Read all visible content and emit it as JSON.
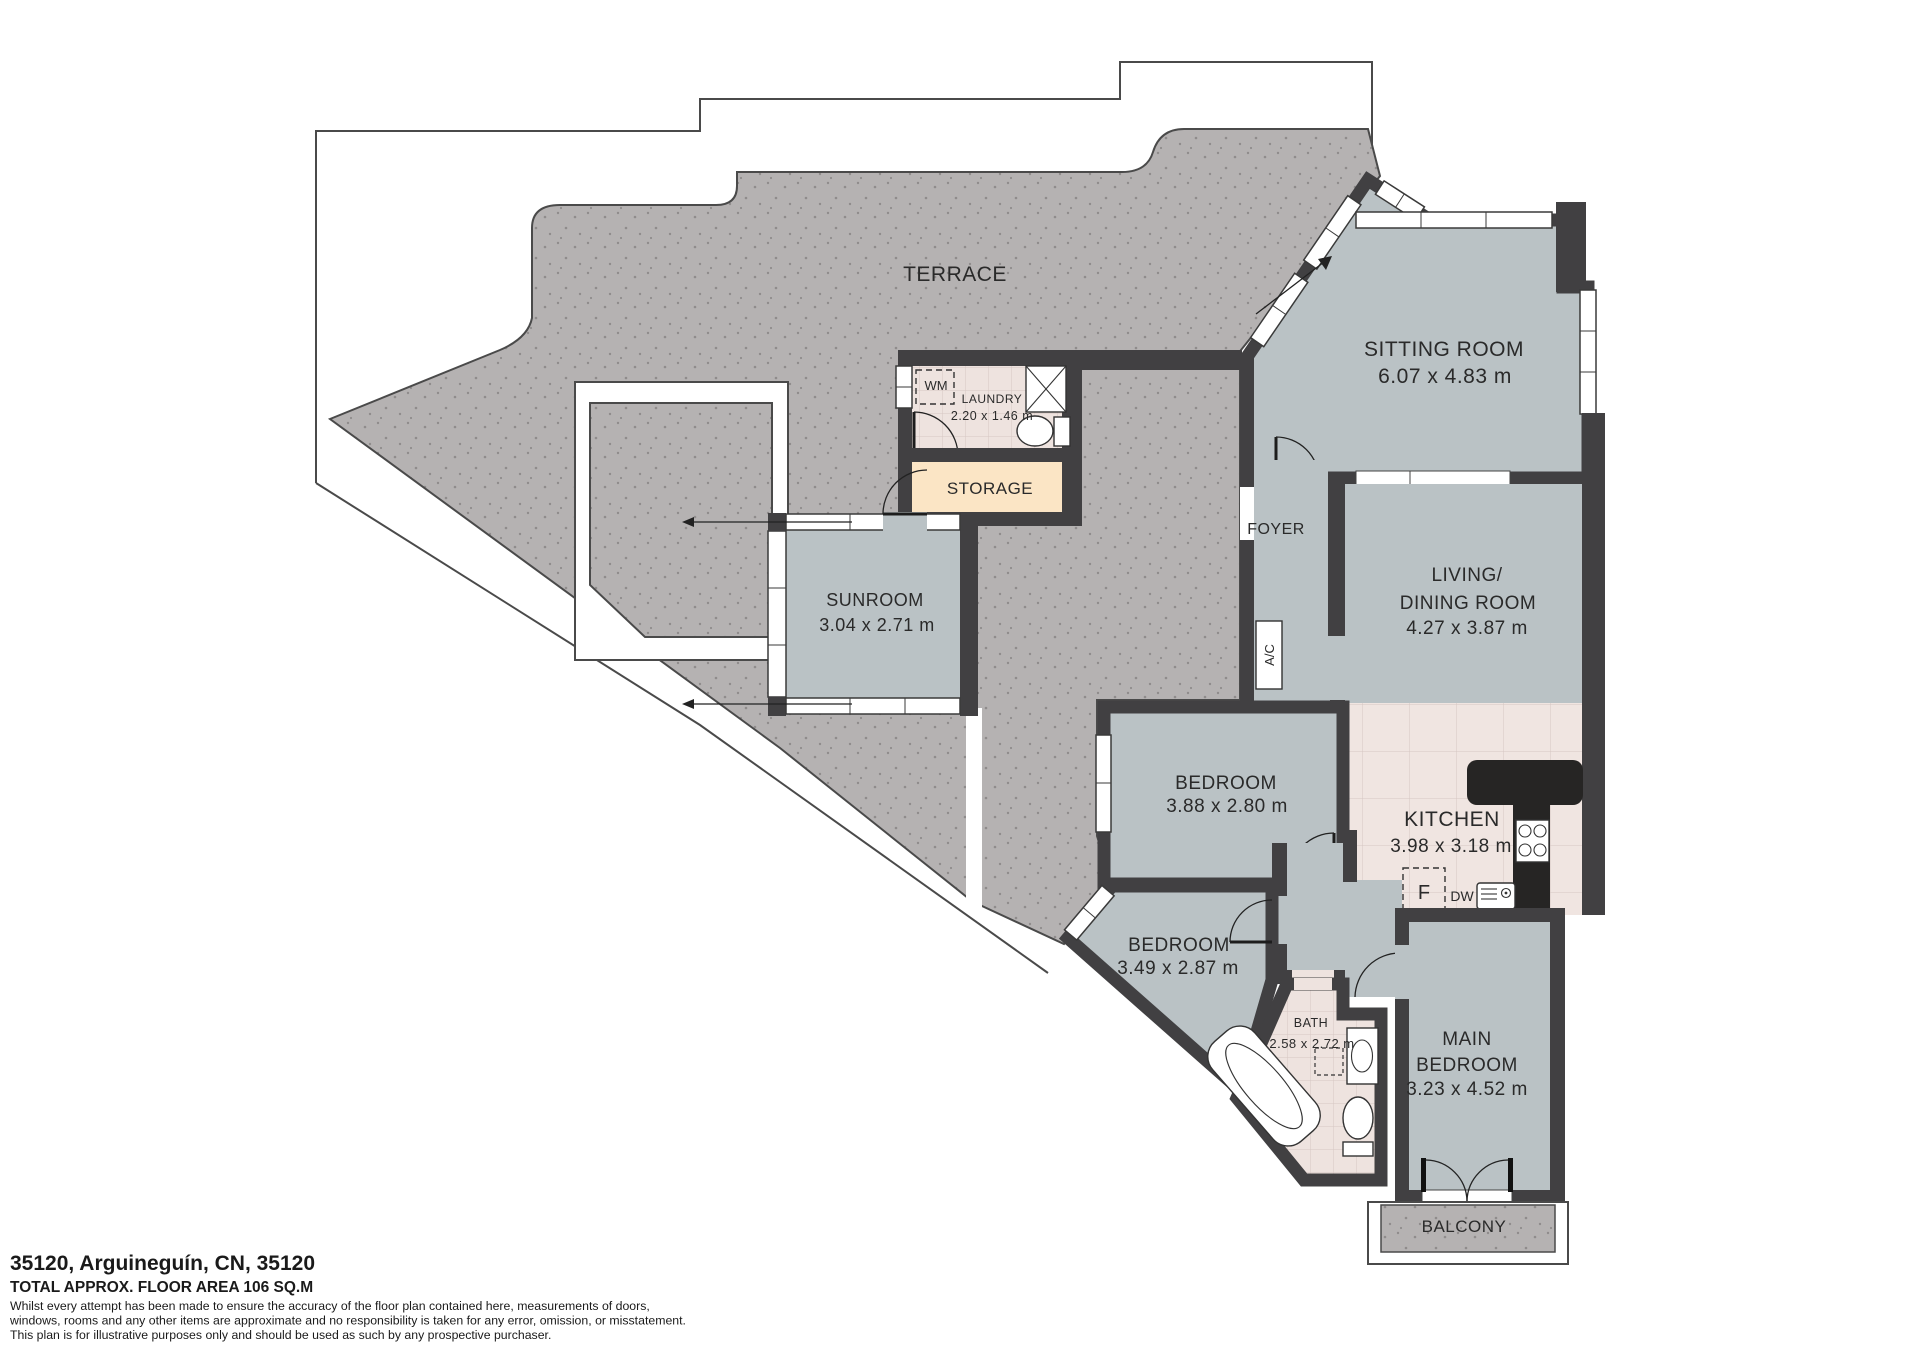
{
  "plan": {
    "terrace_label": "TERRACE",
    "sitting_room": {
      "name": "SITTING ROOM",
      "dims": "6.07 x 4.83 m"
    },
    "living_dining": {
      "name_line1": "LIVING/",
      "name_line2": "DINING ROOM",
      "dims": "4.27 x 3.87 m"
    },
    "foyer_label": "FOYER",
    "kitchen": {
      "name": "KITCHEN",
      "dims": "3.98 x 3.18 m"
    },
    "laundry": {
      "name": "LAUNDRY",
      "dims": "2.20 x 1.46 m"
    },
    "storage_label": "STORAGE",
    "sunroom": {
      "name": "SUNROOM",
      "dims": "3.04 x 2.71 m"
    },
    "bedroom_1": {
      "name": "BEDROOM",
      "dims": "3.88 x 2.80 m"
    },
    "bedroom_2": {
      "name": "BEDROOM",
      "dims": "3.49 x 2.87 m"
    },
    "main_bedroom": {
      "name_line1": "MAIN",
      "name_line2": "BEDROOM",
      "dims": "3.23 x 4.52 m"
    },
    "bath": {
      "name": "BATH",
      "dims": "2.58 x 2.72 m"
    },
    "balcony_label": "BALCONY",
    "fixtures": {
      "washing_machine": "WM",
      "air_conditioning": "A/C",
      "fridge": "F",
      "dishwasher": "DW"
    }
  },
  "footer": {
    "address": "35120, Arguineguín, CN, 35120",
    "total_area": "TOTAL APPROX. FLOOR AREA 106 SQ.M",
    "disclaimer": [
      "Whilst every attempt has been made to ensure the accuracy of the floor plan contained here, measurements of doors,",
      "windows, rooms and any other items are approximate and no responsibility is taken for any error, omission, or misstatement.",
      "This plan is for illustrative purposes only and should be used as such by any prospective purchaser."
    ]
  },
  "colors": {
    "room_fill": "#bac2c5",
    "terrace_fill": "#b5b2b2",
    "wall": "#414042",
    "tile_fill": "#eee3df",
    "storage_fill": "#fbe5c5"
  }
}
